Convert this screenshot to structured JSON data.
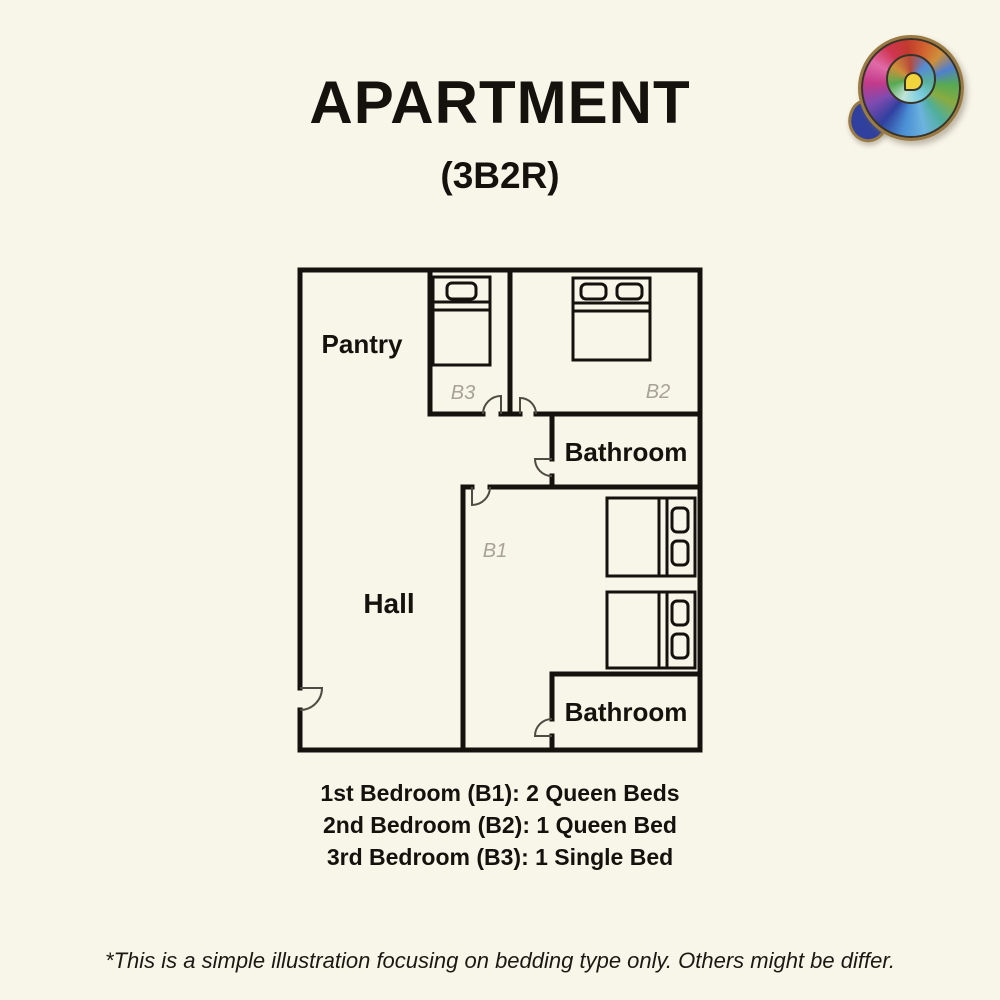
{
  "page": {
    "background_color": "#f8f5e9",
    "title": "APARTMENT",
    "subtitle": "(3B2R)",
    "footnote": "*This is a simple illustration focusing on bedding type only.  Others might be differ."
  },
  "logo": {
    "description": "colorful ammonite shell logo",
    "rim_color": "#9a7b44",
    "core_color": "#f2d43c"
  },
  "floor_plan": {
    "wall_color": "#15120e",
    "door_color": "#4f4b43",
    "room_label_color": "#15120e",
    "bedroom_code_color": "#a8a396",
    "rooms": {
      "pantry": {
        "label": "Pantry"
      },
      "hall": {
        "label": "Hall"
      },
      "bathroom_upper": {
        "label": "Bathroom"
      },
      "bathroom_lower": {
        "label": "Bathroom"
      },
      "bedroom_1": {
        "code": "B1",
        "beds_drawn": 2,
        "bed_type": "queen"
      },
      "bedroom_2": {
        "code": "B2",
        "beds_drawn": 1,
        "bed_type": "queen"
      },
      "bedroom_3": {
        "code": "B3",
        "beds_drawn": 1,
        "bed_type": "single"
      }
    }
  },
  "legend": {
    "lines": [
      "1st Bedroom (B1): 2 Queen Beds",
      "2nd Bedroom (B2): 1 Queen Bed",
      "3rd Bedroom (B3): 1 Single Bed"
    ]
  }
}
